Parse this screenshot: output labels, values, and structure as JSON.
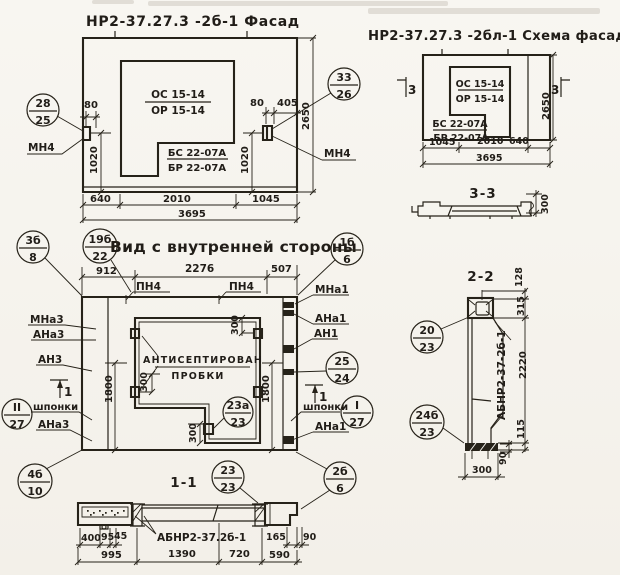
{
  "facade": {
    "title": "НР2-37.27.3 -2б-1 Фасад",
    "win_top": "ОС 15-14",
    "win_bot": "ОР 15-14",
    "blk_top": "БС 22-07А",
    "blk_bot": "БР 22-07А",
    "mn4_left": "МН4",
    "mn4_right": "МН4",
    "d80l": "80",
    "d1020l": "1020",
    "d80r": "80",
    "d405": "405",
    "d1020r": "1020",
    "d640": "640",
    "d2010": "2010",
    "d1045": "1045",
    "d3695": "3695",
    "d2650": "2650",
    "c_left": {
      "top": "28",
      "bot": "25"
    },
    "c_right": {
      "top": "33",
      "bot": "26"
    }
  },
  "schema": {
    "title": "НР2-37.27.3 -2бл-1 Схема фасада",
    "win_top": "ОС 15-14",
    "win_bot": "ОР 15-14",
    "blk_top": "БС 22-07А",
    "blk_bot": "БР 22-07А",
    "cut_left": "3",
    "cut_right": "3",
    "d1045": "1045",
    "d2010": "2010",
    "d640": "640",
    "d3695": "3695",
    "d2650": "2650"
  },
  "sec33": {
    "title": "3-3",
    "d300": "300"
  },
  "inner": {
    "title": "Вид с внутренней стороны",
    "pn4_a": "ПН4",
    "pn4_b": "ПН4",
    "d912": "912",
    "d2276": "2276",
    "d507": "507",
    "d1800l": "1800",
    "d1800r": "1800",
    "d300top": "300",
    "d300left": "300",
    "d300bot": "300",
    "cut1l": "1",
    "cut1r": "1",
    "note1": "АНТИСЕПТИРОВАН",
    "note2": "ПРОБКИ",
    "mna3": "МНа3",
    "ana3": "АНа3",
    "an3": "АН3",
    "shponki_l": "шпонки",
    "ana3b": "АНа3",
    "mna1": "МНа1",
    "ana1": "АНа1",
    "an1": "АН1",
    "shponki_r": "шпонки",
    "ana1b": "АНа1",
    "c3b8": {
      "top": "3б",
      "bot": "8"
    },
    "c19b22": {
      "top": "19б",
      "bot": "22"
    },
    "c1b6": {
      "top": "1б",
      "bot": "6"
    },
    "c2524": {
      "top": "25",
      "bot": "24"
    },
    "cI27": {
      "top": "I",
      "bot": "27"
    },
    "cII27": {
      "top": "II",
      "bot": "27"
    },
    "c23a23": {
      "top": "23а",
      "bot": "23"
    },
    "c2b6": {
      "top": "2б",
      "bot": "6"
    },
    "c4b10": {
      "top": "4б",
      "bot": "10"
    }
  },
  "sec11": {
    "title": "1-1",
    "label": "АБНР2-37.2б-1",
    "d400": "400",
    "d95": "95",
    "d45": "45",
    "d165": "165",
    "d90": "90",
    "d995": "995",
    "d1390": "1390",
    "d720": "720",
    "d590": "590",
    "c2323": {
      "top": "23",
      "bot": "23"
    }
  },
  "sec22": {
    "title": "2-2",
    "label": "АБНР2-37-2б-1",
    "d128": "128",
    "d315": "315",
    "d2220": "2220",
    "d115": "115",
    "d90": "90",
    "d300": "300",
    "c2023": {
      "top": "20",
      "bot": "23"
    },
    "c24b23": {
      "top": "24б",
      "bot": "23"
    }
  }
}
